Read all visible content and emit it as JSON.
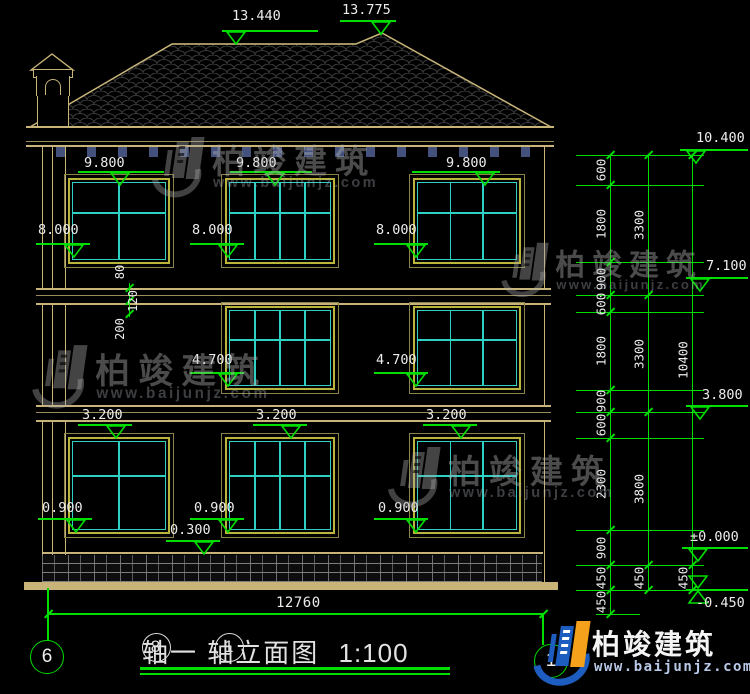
{
  "drawing": {
    "title": {
      "axis_a": "8",
      "after_a": "轴一",
      "axis_b": "1",
      "after_b": "轴立面图",
      "scale": "1:100"
    },
    "axis_bubbles": {
      "left": "6",
      "right": "1"
    },
    "overall_width_dim": "12760"
  },
  "logo": {
    "name": "柏竣建筑",
    "url": "www.baijunjz.com"
  },
  "watermark": {
    "name": "柏竣建筑",
    "url": "www.baijunjz.com"
  },
  "colors": {
    "line_tan": "#c8b478",
    "line_green": "#00dd00",
    "mullion_cyan": "#2fd0c4",
    "frame_yellow": "#b9b43a",
    "text_white": "#ececec",
    "logo_blue": "#1d5dbf",
    "logo_orange": "#f5a11c",
    "tile_gray": "#3c3c3c"
  },
  "elevation_markers": [
    {
      "label": "13.440",
      "text_x": 232,
      "text_y": 8,
      "x1": 222,
      "x2": 318,
      "line_y": 30,
      "tip_x": 236,
      "dir": "down"
    },
    {
      "label": "13.775",
      "text_x": 342,
      "text_y": 2,
      "x1": 340,
      "x2": 396,
      "line_y": 20,
      "tip_x": 381,
      "dir": "down"
    },
    {
      "label": "10.400",
      "text_x": 696,
      "text_y": 130,
      "x1": 680,
      "x2": 748,
      "line_y": 149,
      "tip_x": 696,
      "dir": "down"
    },
    {
      "label": "7.100",
      "text_x": 706,
      "text_y": 258,
      "x1": 686,
      "x2": 748,
      "line_y": 277,
      "tip_x": 700,
      "dir": "down"
    },
    {
      "label": "3.800",
      "text_x": 702,
      "text_y": 387,
      "x1": 686,
      "x2": 748,
      "line_y": 405,
      "tip_x": 700,
      "dir": "down"
    },
    {
      "label": "±0.000",
      "text_x": 690,
      "text_y": 529,
      "x1": 682,
      "x2": 748,
      "line_y": 547,
      "tip_x": 698,
      "dir": "down"
    },
    {
      "label": "-0.450",
      "text_x": 696,
      "text_y": 595,
      "x1": 686,
      "x2": 748,
      "line_y": 589,
      "tip_x": 698,
      "dir": "below"
    },
    {
      "label": "9.800",
      "text_x": 84,
      "text_y": 155,
      "x1": 78,
      "x2": 164,
      "line_y": 171,
      "tip_x": 120,
      "dir": "down"
    },
    {
      "label": "9.800",
      "text_x": 236,
      "text_y": 155,
      "x1": 230,
      "x2": 312,
      "line_y": 171,
      "tip_x": 275,
      "dir": "down"
    },
    {
      "label": "9.800",
      "text_x": 446,
      "text_y": 155,
      "x1": 412,
      "x2": 500,
      "line_y": 171,
      "tip_x": 485,
      "dir": "down"
    },
    {
      "label": "8.000",
      "text_x": 38,
      "text_y": 222,
      "x1": 36,
      "x2": 90,
      "line_y": 243,
      "tip_x": 74,
      "dir": "down"
    },
    {
      "label": "8.000",
      "text_x": 192,
      "text_y": 222,
      "x1": 190,
      "x2": 244,
      "line_y": 243,
      "tip_x": 228,
      "dir": "down"
    },
    {
      "label": "8.000",
      "text_x": 376,
      "text_y": 222,
      "x1": 374,
      "x2": 428,
      "line_y": 243,
      "tip_x": 416,
      "dir": "down"
    },
    {
      "label": "4.700",
      "text_x": 192,
      "text_y": 352,
      "x1": 190,
      "x2": 244,
      "line_y": 372,
      "tip_x": 228,
      "dir": "down"
    },
    {
      "label": "4.700",
      "text_x": 376,
      "text_y": 352,
      "x1": 374,
      "x2": 428,
      "line_y": 372,
      "tip_x": 416,
      "dir": "down"
    },
    {
      "label": "3.200",
      "text_x": 82,
      "text_y": 407,
      "x1": 78,
      "x2": 132,
      "line_y": 424,
      "tip_x": 116,
      "dir": "down"
    },
    {
      "label": "3.200",
      "text_x": 256,
      "text_y": 407,
      "x1": 253,
      "x2": 307,
      "line_y": 424,
      "tip_x": 291,
      "dir": "down"
    },
    {
      "label": "3.200",
      "text_x": 426,
      "text_y": 407,
      "x1": 423,
      "x2": 477,
      "line_y": 424,
      "tip_x": 461,
      "dir": "down"
    },
    {
      "label": "0.900",
      "text_x": 42,
      "text_y": 500,
      "x1": 38,
      "x2": 92,
      "line_y": 518,
      "tip_x": 76,
      "dir": "down"
    },
    {
      "label": "0.900",
      "text_x": 194,
      "text_y": 500,
      "x1": 190,
      "x2": 244,
      "line_y": 518,
      "tip_x": 228,
      "dir": "down"
    },
    {
      "label": "0.900",
      "text_x": 378,
      "text_y": 500,
      "x1": 374,
      "x2": 428,
      "line_y": 518,
      "tip_x": 416,
      "dir": "down"
    },
    {
      "label": "0.300",
      "text_x": 170,
      "text_y": 522,
      "x1": 166,
      "x2": 220,
      "line_y": 540,
      "tip_x": 204,
      "dir": "down"
    }
  ],
  "right_dim_chain": {
    "levels": [
      155,
      185,
      262,
      295,
      312,
      390,
      412,
      438,
      530,
      565,
      590,
      614
    ],
    "ext_x1": 576,
    "ext_x2": 704,
    "columns": [
      {
        "x": 610,
        "segments": [
          {
            "from": 0,
            "to": 1,
            "label": "600"
          },
          {
            "from": 1,
            "to": 2,
            "label": "1800"
          },
          {
            "from": 2,
            "to": 3,
            "label": "900"
          },
          {
            "from": 3,
            "to": 4,
            "label": "600"
          },
          {
            "from": 4,
            "to": 5,
            "label": "1800"
          },
          {
            "from": 5,
            "to": 6,
            "label": "900"
          },
          {
            "from": 6,
            "to": 7,
            "label": "600"
          },
          {
            "from": 7,
            "to": 8,
            "label": "2300"
          },
          {
            "from": 8,
            "to": 9,
            "label": "900"
          },
          {
            "from": 9,
            "to": 10,
            "label": "450"
          },
          {
            "from": 10,
            "to": 11,
            "label": "450"
          }
        ]
      },
      {
        "x": 648,
        "segments": [
          {
            "from": 0,
            "to": 3,
            "label": "3300"
          },
          {
            "from": 3,
            "to": 6,
            "label": "3300"
          },
          {
            "from": 6,
            "to": 9,
            "label": "3800"
          },
          {
            "from": 9,
            "to": 10,
            "label": "450"
          }
        ]
      },
      {
        "x": 692,
        "segments": [
          {
            "from": 0,
            "to": 9,
            "label": "10400"
          },
          {
            "from": 9,
            "to": 10,
            "label": "450"
          }
        ]
      }
    ]
  },
  "band_dims": [
    {
      "label": "80",
      "x": 120,
      "y": 272
    },
    {
      "label": "120",
      "x": 133,
      "y": 301
    },
    {
      "label": "200",
      "x": 120,
      "y": 329
    }
  ],
  "windows": [
    {
      "x": 68,
      "y": 178,
      "w": 102,
      "h": 86,
      "cols": 2
    },
    {
      "x": 225,
      "y": 178,
      "w": 110,
      "h": 86,
      "cols": 4
    },
    {
      "x": 413,
      "y": 178,
      "w": 108,
      "h": 86,
      "cols": 3
    },
    {
      "x": 225,
      "y": 306,
      "w": 110,
      "h": 84,
      "cols": 4
    },
    {
      "x": 413,
      "y": 306,
      "w": 108,
      "h": 84,
      "cols": 3
    },
    {
      "x": 68,
      "y": 437,
      "w": 102,
      "h": 97,
      "cols": 2
    },
    {
      "x": 225,
      "y": 437,
      "w": 110,
      "h": 97,
      "cols": 4
    },
    {
      "x": 413,
      "y": 437,
      "w": 108,
      "h": 97,
      "cols": 3
    }
  ],
  "watermarks_pos": [
    {
      "x": 146,
      "y": 130,
      "s": 1.0
    },
    {
      "x": 496,
      "y": 236,
      "s": 0.9
    },
    {
      "x": 26,
      "y": 338,
      "s": 1.05
    },
    {
      "x": 382,
      "y": 440,
      "s": 1.0
    }
  ]
}
